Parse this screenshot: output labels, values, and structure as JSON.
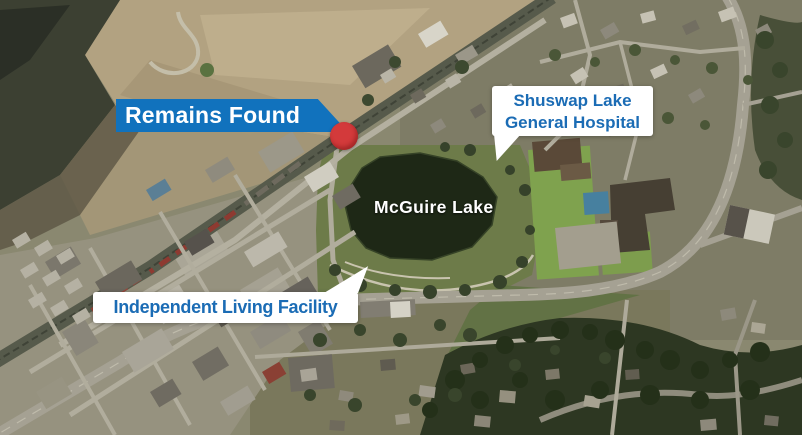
{
  "annotations": {
    "remains_banner": {
      "label": "Remains Found"
    },
    "hospital_callout": {
      "line1": "Shuswap Lake",
      "line2": "General Hospital"
    },
    "facility_callout": {
      "label": "Independent Living Facility"
    },
    "lake_label": "McGuire Lake"
  },
  "colors": {
    "banner_blue": "#1172bd",
    "callout_text_blue": "#1b6cb5",
    "marker_red": "#d33a3b",
    "lake_water": "#1e2816"
  }
}
